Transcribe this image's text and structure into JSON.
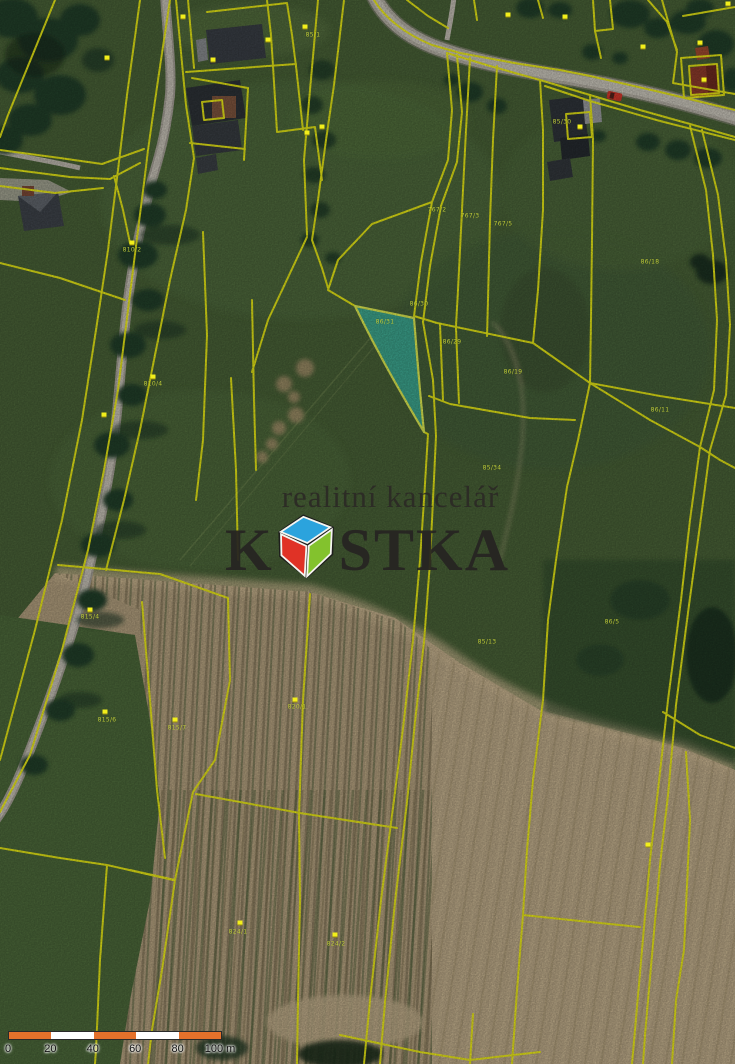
{
  "branding": {
    "tagline": "realitní kancelář",
    "brand_prefix": "K",
    "brand_suffix": "STKA",
    "logo_colors": {
      "top": "#2ba3dd",
      "left": "#e03226",
      "right": "#83c22d"
    }
  },
  "scalebar": {
    "unit_labels": [
      "0",
      "20",
      "40",
      "60",
      "80",
      "100 m"
    ],
    "segment_colors": [
      "#e4712b",
      "#ffffff",
      "#e4712b",
      "#ffffff",
      "#e4712b"
    ]
  },
  "highlight": {
    "parcel_label": "86/31",
    "fill": "#38d4c6",
    "border": "#e3f053"
  },
  "cadastral": {
    "line_color": "#f2f216",
    "marker_color": "#f2ef1b",
    "label_color": "#c9d53b",
    "parcel_labels": [
      {
        "text": "85/1",
        "x": 313,
        "y": 35
      },
      {
        "text": "767/2",
        "x": 437,
        "y": 210
      },
      {
        "text": "767/3",
        "x": 470,
        "y": 216
      },
      {
        "text": "767/5",
        "x": 503,
        "y": 224
      },
      {
        "text": "85/30",
        "x": 562,
        "y": 122
      },
      {
        "text": "86/18",
        "x": 650,
        "y": 262
      },
      {
        "text": "86/30",
        "x": 419,
        "y": 304
      },
      {
        "text": "86/31",
        "x": 385,
        "y": 322
      },
      {
        "text": "86/29",
        "x": 452,
        "y": 342
      },
      {
        "text": "86/19",
        "x": 513,
        "y": 372
      },
      {
        "text": "86/11",
        "x": 660,
        "y": 410
      },
      {
        "text": "85/34",
        "x": 492,
        "y": 468
      },
      {
        "text": "85/13",
        "x": 487,
        "y": 642
      },
      {
        "text": "86/5",
        "x": 612,
        "y": 622
      },
      {
        "text": "824/1",
        "x": 238,
        "y": 932
      },
      {
        "text": "824/2",
        "x": 336,
        "y": 944
      },
      {
        "text": "815/4",
        "x": 90,
        "y": 617
      },
      {
        "text": "815/6",
        "x": 107,
        "y": 720
      },
      {
        "text": "815/7",
        "x": 177,
        "y": 728
      },
      {
        "text": "820/1",
        "x": 297,
        "y": 707
      },
      {
        "text": "810/2",
        "x": 132,
        "y": 250
      },
      {
        "text": "810/4",
        "x": 153,
        "y": 384
      }
    ],
    "markers": [
      {
        "x": 107,
        "y": 58
      },
      {
        "x": 183,
        "y": 17
      },
      {
        "x": 213,
        "y": 60
      },
      {
        "x": 268,
        "y": 40
      },
      {
        "x": 307,
        "y": 133
      },
      {
        "x": 305,
        "y": 27
      },
      {
        "x": 322,
        "y": 127
      },
      {
        "x": 508,
        "y": 15
      },
      {
        "x": 565,
        "y": 17
      },
      {
        "x": 643,
        "y": 47
      },
      {
        "x": 700,
        "y": 43
      },
      {
        "x": 728,
        "y": 4
      },
      {
        "x": 580,
        "y": 127
      },
      {
        "x": 704,
        "y": 80
      },
      {
        "x": 132,
        "y": 243
      },
      {
        "x": 153,
        "y": 377
      },
      {
        "x": 104,
        "y": 415
      },
      {
        "x": 90,
        "y": 610
      },
      {
        "x": 105,
        "y": 712
      },
      {
        "x": 175,
        "y": 720
      },
      {
        "x": 295,
        "y": 700
      },
      {
        "x": 240,
        "y": 923
      },
      {
        "x": 335,
        "y": 935
      },
      {
        "x": 648,
        "y": 845
      }
    ]
  }
}
